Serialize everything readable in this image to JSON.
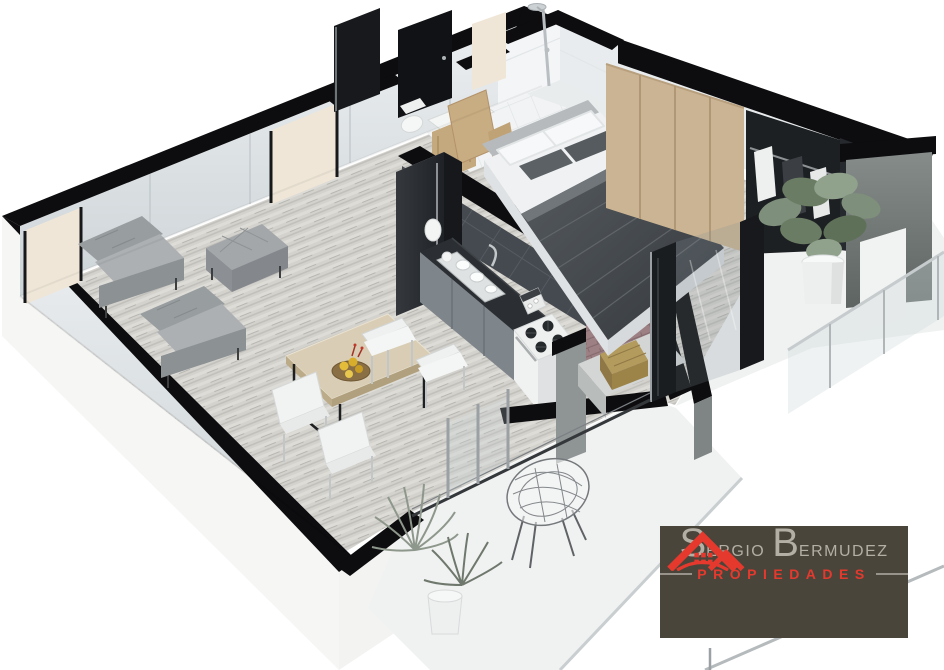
{
  "scene": {
    "description": "3D isometric cutaway render of a one-bedroom apartment floor plan",
    "rooms": [
      "living room",
      "dining area",
      "kitchen",
      "entry",
      "bathroom",
      "bedroom",
      "wardrobe",
      "bedroom balcony",
      "terrace",
      "laundry nook"
    ],
    "furniture": [
      "two gray armchairs",
      "gray ottoman",
      "wood dining table with fruit bowl",
      "four white chairs",
      "black refrigerator",
      "kitchen counter with sink and dishes",
      "coffee maker",
      "white gas stove",
      "double bed with dark blanket and pillows",
      "wardrobe with hanging clothes",
      "potted plant",
      "wire chair",
      "spiky terrace plants"
    ]
  },
  "palette": {
    "wall-cap": "#0d0d0f",
    "wood-floor": "#d4d2cd",
    "floor-white": "#f0f1f1",
    "charcoal": "#2b2f33",
    "sofa-gray": "#a3a7aa",
    "wood-furniture": "#c9ad82",
    "concrete": "#8f9494",
    "brick": "#9c8084",
    "plant-green": "#7e8f7b",
    "logo-bg": "#4a453b",
    "logo-text": "#b3afa5",
    "accent": "#e6392e"
  },
  "logo": {
    "brand_initial_1": "S",
    "brand_rest_1": "ERGIO",
    "brand_initial_2": "B",
    "brand_rest_2": "ERMUDEZ",
    "tagline": "PROPIEDADES"
  }
}
